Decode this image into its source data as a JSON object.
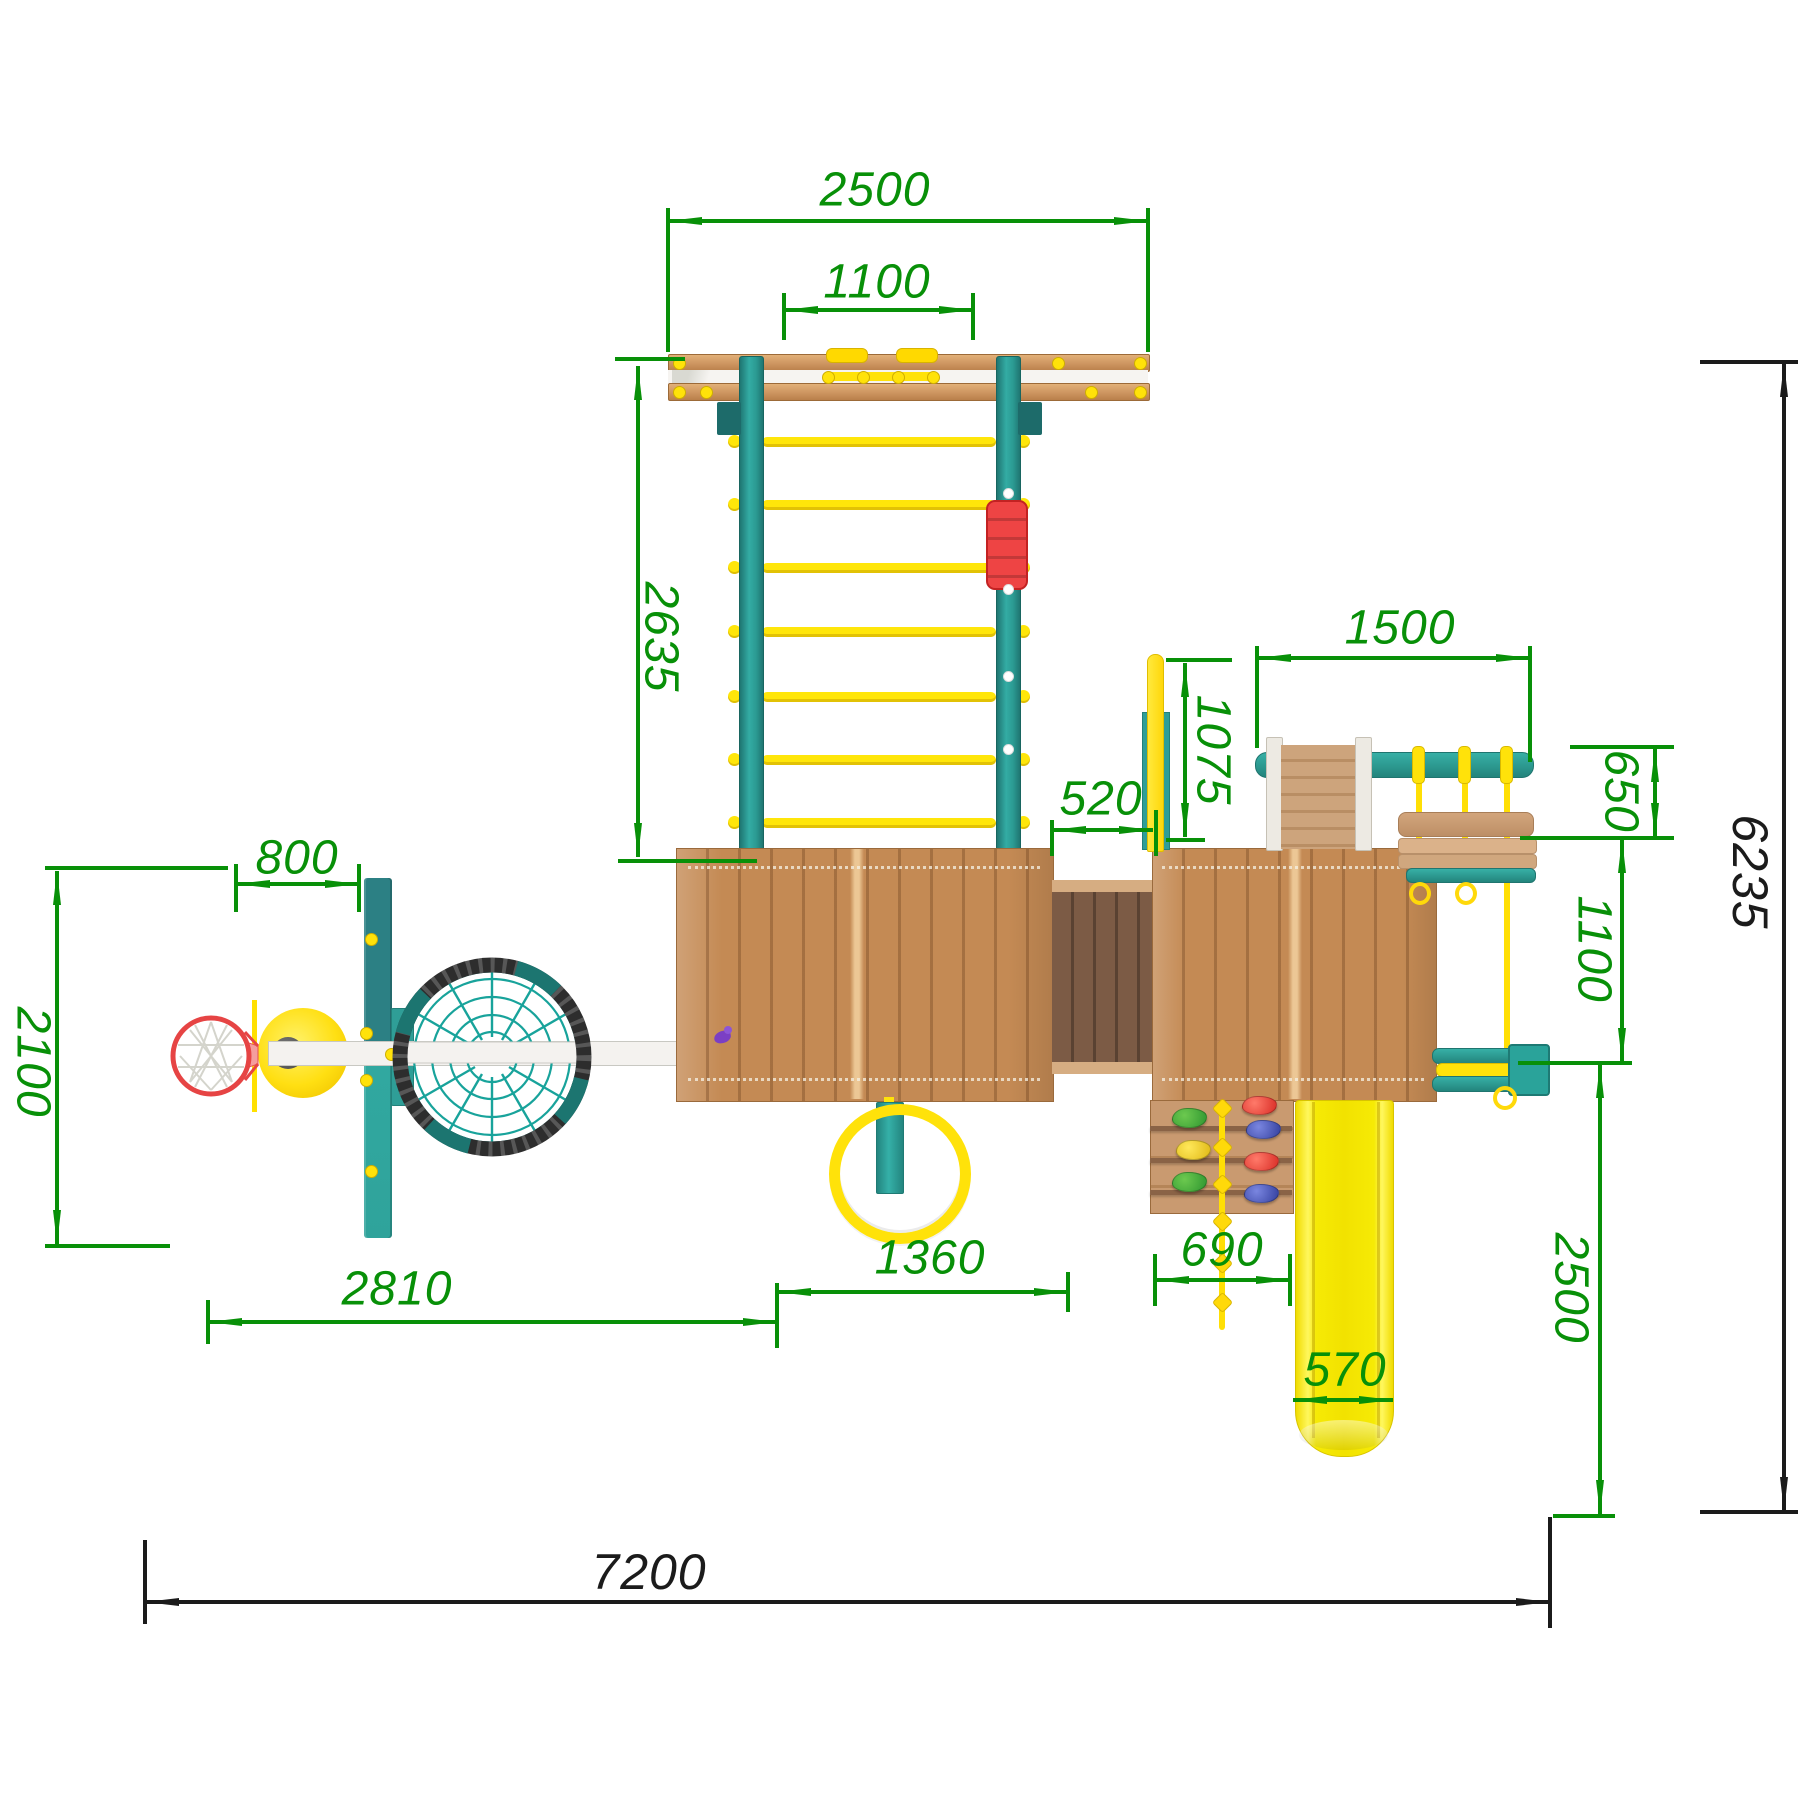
{
  "title": "Playground set installation plan - top view",
  "units": "mm",
  "dims": {
    "top_beam_length": "2500",
    "top_rung_span": "1100",
    "ladder_height": "2635",
    "swing_beam_length": "1500",
    "pole_offset": "1075",
    "roof_gap": "520",
    "bench_swing_depth": "650",
    "swing_clearance": "1100",
    "overall_depth": "6235",
    "backboard_offset": "800",
    "basketball_zone_depth": "2100",
    "left_zone_length": "2810",
    "ring_zone_length": "1360",
    "climb_wall_width": "690",
    "slide_runout_depth": "2500",
    "slide_width": "570",
    "overall_length": "7200"
  },
  "colors": {
    "dimension_green": "#089008",
    "dimension_black": "#1b1b1b",
    "teal": "#2fa39b",
    "wood": "#c48a54",
    "yellow": "#ffe20a",
    "red": "#ee4444",
    "beam_white": "#f4f2ef"
  }
}
